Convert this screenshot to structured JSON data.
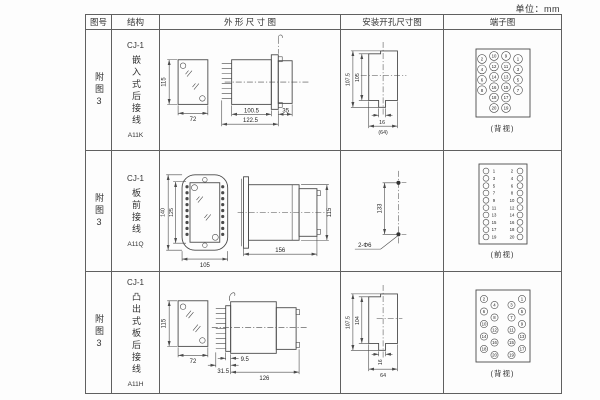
{
  "unit_label": "单位：mm",
  "colors": {
    "line": "#4a4a4a",
    "text": "#222222",
    "background": "#fdfdfd"
  },
  "header": {
    "fig_no": "图号",
    "structure": "结构",
    "outline": "外 形 尺 寸 图",
    "install": "安装开孔尺寸图",
    "terminal": "端子图"
  },
  "rows": [
    {
      "fig_no": "附图3",
      "series": "CJ-1",
      "structure": "嵌入式后接线",
      "model": "A11K",
      "outline": {
        "front_height": "115",
        "front_width": "72",
        "body_len": "100.5",
        "total_len": "122.5",
        "rear_len": "35"
      },
      "install": {
        "outer_h": "107.5",
        "inner_h": "105",
        "slot_w": "16",
        "overall_w": "(64)"
      },
      "terminal": {
        "view_label": "(背视)",
        "outer_left": [
          2,
          4,
          6,
          8
        ],
        "inner_left": [
          10,
          12,
          14,
          16,
          18,
          20
        ],
        "inner_right": [
          9,
          11,
          13,
          15,
          17,
          19
        ],
        "outer_right": [
          1,
          3,
          5,
          7
        ]
      }
    },
    {
      "fig_no": "附图3",
      "series": "CJ-1",
      "structure": "板前接线",
      "model": "A11Q",
      "outline": {
        "outer_h": "140",
        "inner_h": "125",
        "width": "105",
        "side_len": "156",
        "side_h": "115"
      },
      "install": {
        "hole_pitch": "133",
        "hole_label": "2-Φ6"
      },
      "terminal": {
        "view_label": "(前视)",
        "left": [
          1,
          3,
          5,
          7,
          9,
          11,
          13,
          15,
          17,
          19
        ],
        "right": [
          2,
          4,
          6,
          8,
          10,
          12,
          14,
          16,
          18,
          20
        ]
      }
    },
    {
      "fig_no": "附图3",
      "series": "CJ-1",
      "structure": "凸出式板后接线",
      "model": "A11H",
      "outline": {
        "front_height": "115",
        "front_width": "72",
        "plate_offset": "9.5",
        "pin_section": "31.5",
        "body_len": "126"
      },
      "install": {
        "outer_h": "107.5",
        "inner_h": "104",
        "slot_w": "16",
        "overall_w": "64"
      },
      "terminal": {
        "view_label": "(背视)",
        "outer_left": [
          2,
          6,
          10,
          14,
          18
        ],
        "inner_left": [
          4,
          8,
          12,
          16,
          20
        ],
        "inner_right": [
          3,
          7,
          11,
          15,
          19
        ],
        "outer_right": [
          1,
          5,
          9,
          13,
          17
        ]
      }
    }
  ]
}
